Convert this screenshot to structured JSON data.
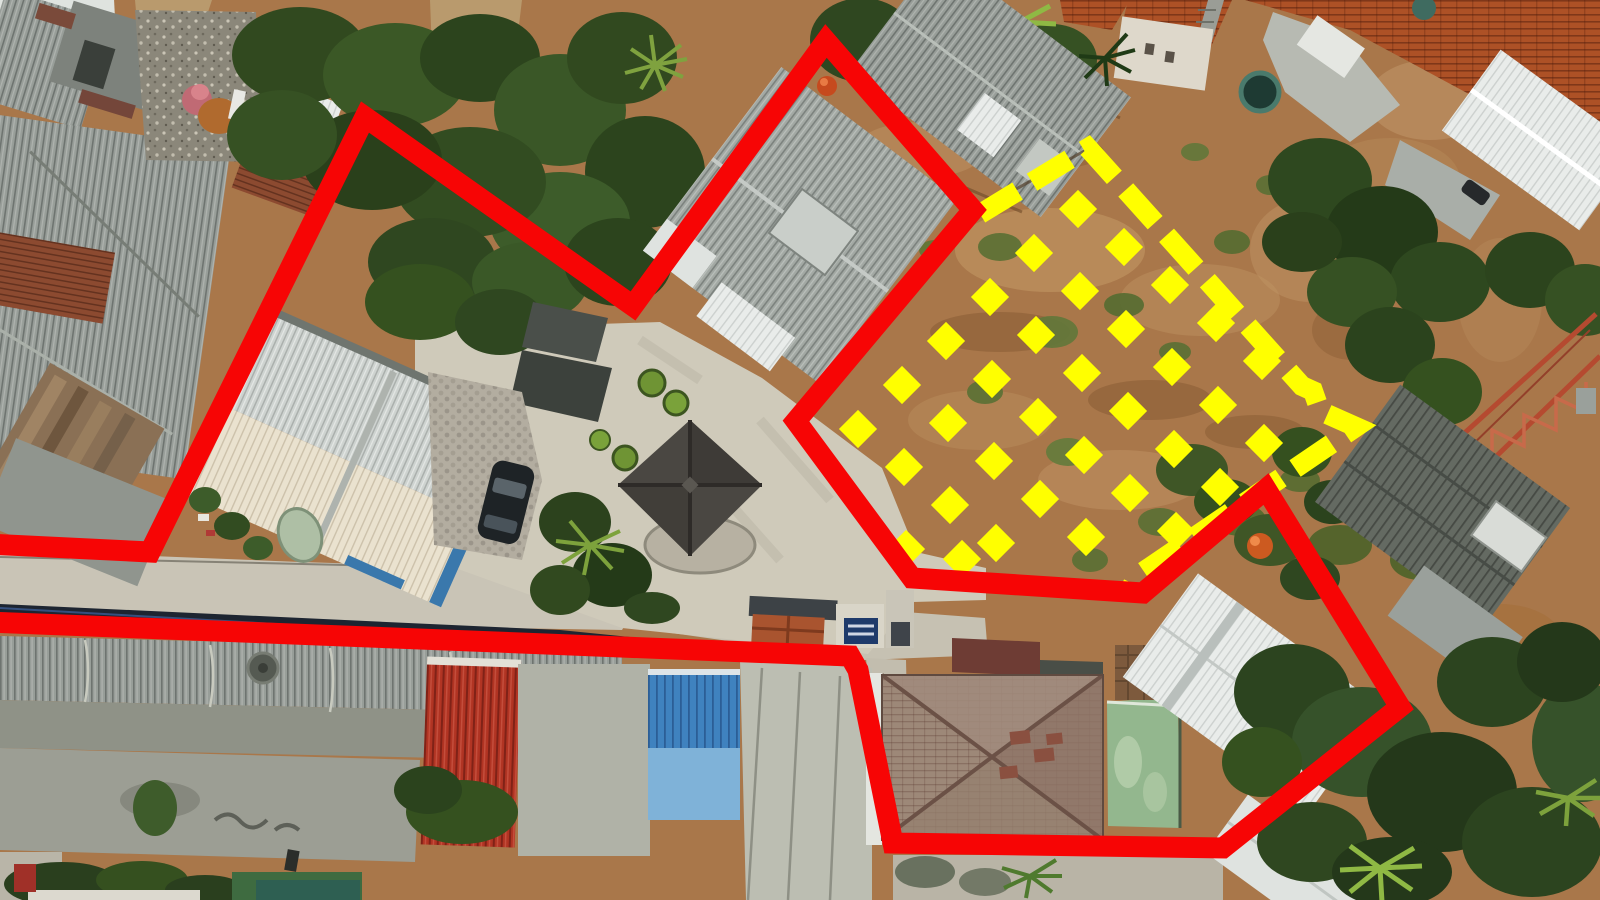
{
  "image": {
    "type": "aerial-drone-photo",
    "subject": "residential neighborhood with surveyed land parcels",
    "width": 1600,
    "height": 900
  },
  "colors": {
    "boundary_red": "#f70505",
    "boundary_yellow": "#ffff00"
  },
  "annotations": {
    "red_boundary": {
      "shape": "open-polyline",
      "stroke_width": 21,
      "points": [
        [
          -12,
          544
        ],
        [
          150,
          552
        ],
        [
          365,
          117
        ],
        [
          633,
          306
        ],
        [
          826,
          41
        ],
        [
          973,
          210
        ],
        [
          796,
          421
        ],
        [
          912,
          578
        ],
        [
          1143,
          593
        ],
        [
          1266,
          489
        ],
        [
          1392,
          694
        ],
        [
          1400,
          707
        ],
        [
          1223,
          848
        ],
        [
          893,
          843
        ],
        [
          858,
          670
        ],
        [
          850,
          656
        ],
        [
          -12,
          622
        ]
      ]
    },
    "yellow_boundary": {
      "shape": "dashed-polyline",
      "stroke_width": 20,
      "dash": [
        44,
        17
      ],
      "points": [
        [
          980,
          214
        ],
        [
          1088,
          148
        ],
        [
          1302,
          386
        ],
        [
          1313,
          391
        ],
        [
          1320,
          411
        ],
        [
          1356,
          427
        ],
        [
          1137,
          576
        ],
        [
          1130,
          590
        ]
      ]
    },
    "yellow_diamonds": {
      "shape": "rotated-squares",
      "size": 27,
      "centers": [
        [
          990,
          297
        ],
        [
          1034,
          253
        ],
        [
          1078,
          209
        ],
        [
          1036,
          335
        ],
        [
          1080,
          291
        ],
        [
          1124,
          247
        ],
        [
          1082,
          373
        ],
        [
          1126,
          329
        ],
        [
          1170,
          285
        ],
        [
          1128,
          411
        ],
        [
          1172,
          367
        ],
        [
          1216,
          323
        ],
        [
          1174,
          449
        ],
        [
          1218,
          405
        ],
        [
          1262,
          361
        ],
        [
          1220,
          487
        ],
        [
          1264,
          443
        ],
        [
          946,
          341
        ],
        [
          992,
          379
        ],
        [
          1038,
          417
        ],
        [
          1084,
          455
        ],
        [
          1130,
          493
        ],
        [
          1176,
          531
        ],
        [
          902,
          385
        ],
        [
          948,
          423
        ],
        [
          994,
          461
        ],
        [
          1040,
          499
        ],
        [
          1086,
          537
        ],
        [
          858,
          429
        ],
        [
          904,
          467
        ],
        [
          950,
          505
        ],
        [
          996,
          543
        ],
        [
          906,
          549
        ],
        [
          962,
          559
        ]
      ]
    }
  }
}
